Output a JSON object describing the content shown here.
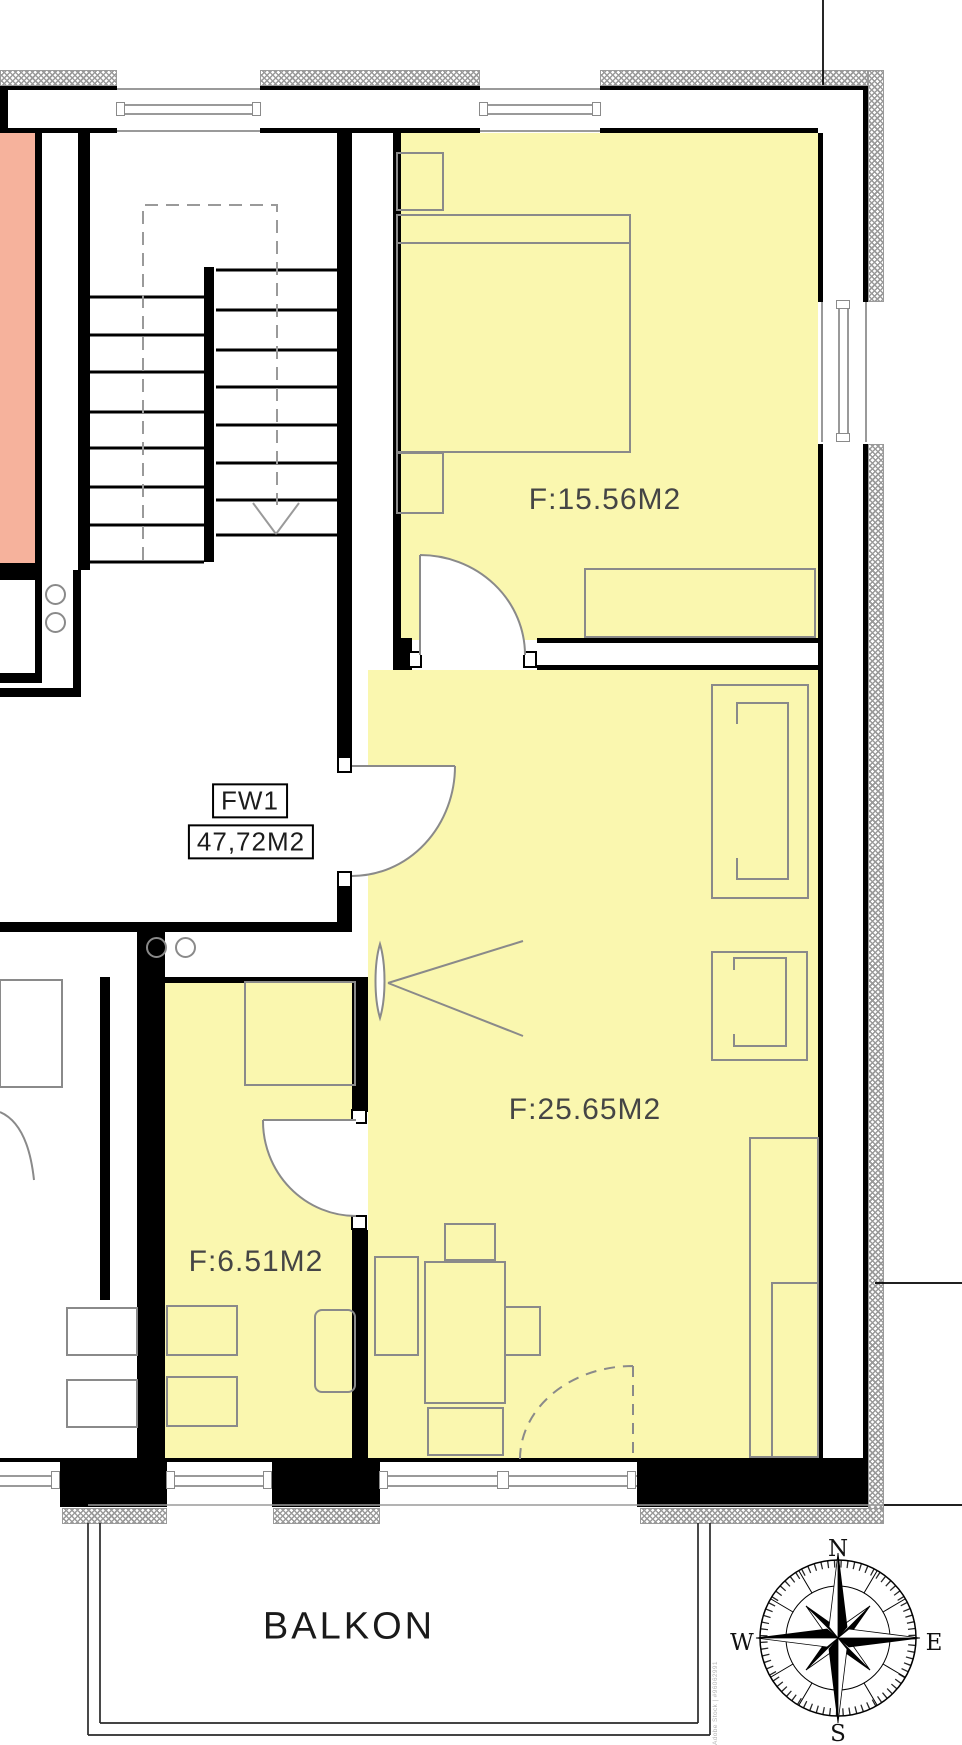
{
  "plan": {
    "type": "apartment floor plan",
    "unit": {
      "id_label": "FW1",
      "total_area_label": "47,72M2",
      "rooms": [
        {
          "name": "bedroom",
          "area_label": "F:15.56M2"
        },
        {
          "name": "living-room",
          "area_label": "F:25.65M2"
        },
        {
          "name": "kitchen",
          "area_label": "F:6.51M2"
        }
      ],
      "balcony_label": "BALKON"
    },
    "colors": {
      "unit_room_fill": "#faf7af",
      "neighbor_room_fill": "#f6b29c",
      "wall": "#000000",
      "furniture_line": "#8a8a8a",
      "insulation_hatch": "#9a9a9a",
      "area_label_text": "#454545"
    }
  },
  "compass": {
    "north": "N",
    "south": "S",
    "east": "E",
    "west": "W"
  },
  "watermark": {
    "text": "Adobe Stock | #96062991"
  }
}
